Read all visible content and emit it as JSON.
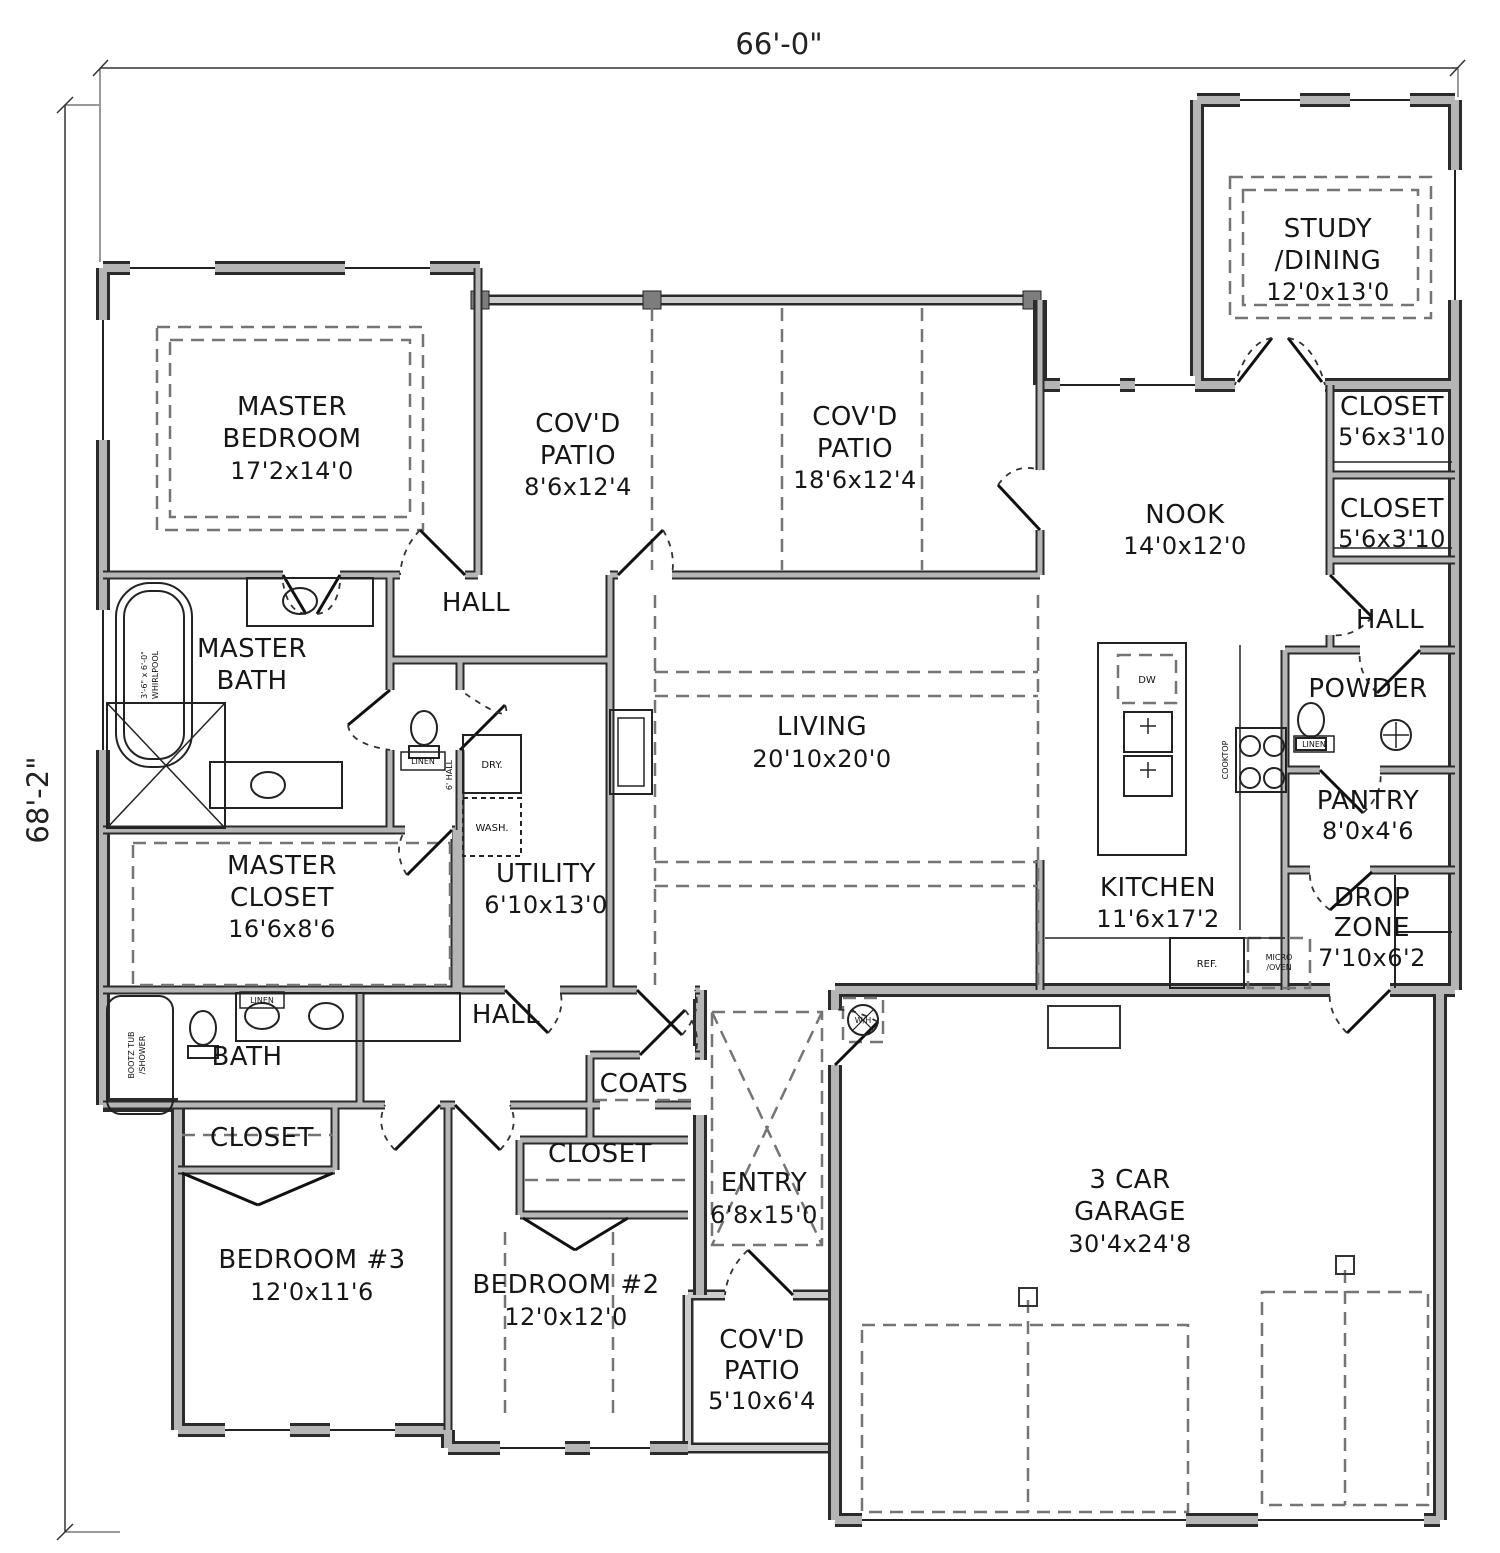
{
  "dimensions": {
    "top": "66'-0\"",
    "left": "68'-2\""
  },
  "rooms": {
    "master_bedroom": {
      "line1": "MASTER",
      "line2": "BEDROOM",
      "dims": "17'2x14'0"
    },
    "covd_patio_left": {
      "line1": "COV'D",
      "line2": "PATIO",
      "dims": "8'6x12'4"
    },
    "covd_patio_right": {
      "line1": "COV'D",
      "line2": "PATIO",
      "dims": "18'6x12'4"
    },
    "study_dining": {
      "line1": "STUDY",
      "line2": "/DINING",
      "dims": "12'0x13'0"
    },
    "closet_upper": {
      "line1": "CLOSET",
      "dims": "5'6x3'10"
    },
    "closet_lower": {
      "line1": "CLOSET",
      "dims": "5'6x3'10"
    },
    "hall_right": {
      "line1": "HALL"
    },
    "nook": {
      "line1": "NOOK",
      "dims": "14'0x12'0"
    },
    "living": {
      "line1": "LIVING",
      "dims": "20'10x20'0"
    },
    "master_bath": {
      "line1": "MASTER",
      "line2": "BATH"
    },
    "hall_upper": {
      "line1": "HALL"
    },
    "master_closet": {
      "line1": "MASTER",
      "line2": "CLOSET",
      "dims": "16'6x8'6"
    },
    "utility": {
      "line1": "UTILITY",
      "dims": "6'10x13'0"
    },
    "kitchen": {
      "line1": "KITCHEN",
      "dims": "11'6x17'2"
    },
    "powder": {
      "line1": "POWDER"
    },
    "pantry": {
      "line1": "PANTRY",
      "dims": "8'0x4'6"
    },
    "drop_zone": {
      "line1": "DROP",
      "line2": "ZONE",
      "dims": "7'10x6'2"
    },
    "bath": {
      "line1": "BATH"
    },
    "hall_middle": {
      "line1": "HALL"
    },
    "coats": {
      "line1": "COATS"
    },
    "closet_bedroom3": {
      "line1": "CLOSET"
    },
    "closet_bedroom2": {
      "line1": "CLOSET"
    },
    "bedroom3": {
      "line1": "BEDROOM #3",
      "dims": "12'0x11'6"
    },
    "bedroom2": {
      "line1": "BEDROOM #2",
      "dims": "12'0x12'0"
    },
    "entry": {
      "line1": "ENTRY",
      "dims": "6'8x15'0"
    },
    "covd_patio_front": {
      "line1": "COV'D",
      "line2": "PATIO",
      "dims": "5'10x6'4"
    },
    "garage": {
      "line1": "3 CAR",
      "line2": "GARAGE",
      "dims": "30'4x24'8"
    }
  },
  "fixtures": {
    "whirlpool_line1": "3'-6\" x 6'-0\"",
    "whirlpool_line2": "WHIRLPOOL",
    "bootz_line1": "BOOTZ TUB",
    "bootz_line2": "/SHOWER",
    "linen_master": "LINEN",
    "linen_bath": "LINEN",
    "linen_powder": "LINEN",
    "dry": "DRY.",
    "wash": "WASH.",
    "dw": "DW",
    "cooktop": "COOKTOP",
    "ref": "REF.",
    "micro_line1": "MICRO",
    "micro_line2": "/OVEN",
    "wh": "W/H",
    "hall_small": "6' HALL"
  },
  "colors": {
    "wall_fill": "#b5b5b5",
    "wall_edge": "#2b2b2b",
    "dash": "#757575",
    "text": "#1a1a1a",
    "background": "#ffffff"
  }
}
